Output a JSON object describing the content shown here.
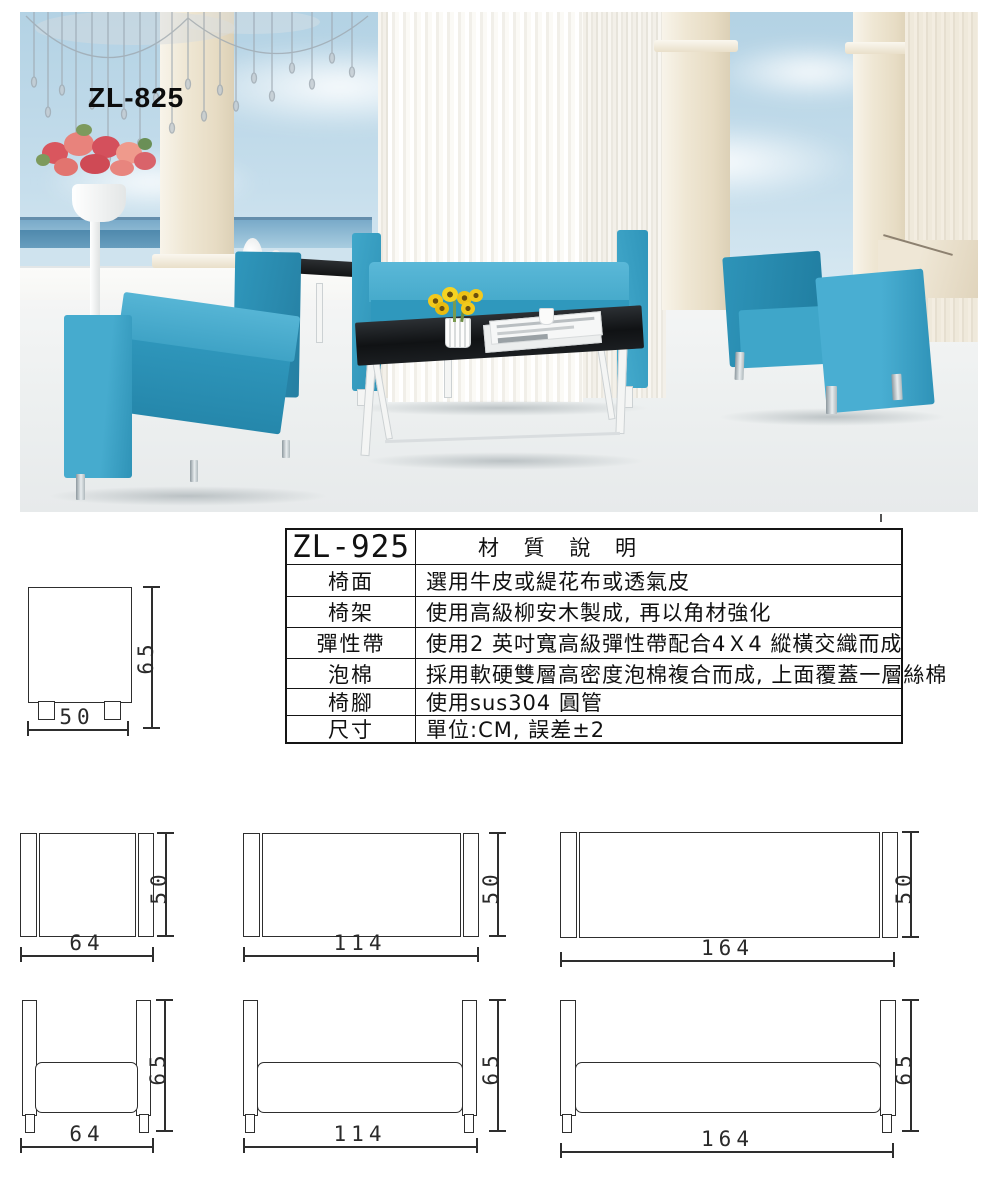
{
  "product": {
    "photo_label": "ZL-825"
  },
  "spec_table": {
    "model": "ZL-925",
    "title": "材 質 說 明",
    "rows": [
      {
        "label": "椅面",
        "value": "選用牛皮或緹花布或透氣皮"
      },
      {
        "label": "椅架",
        "value": "使用高級柳安木製成, 再以角材強化"
      },
      {
        "label": "彈性帶",
        "value": "使用2 英吋寬高級彈性帶配合4Ｘ4 縱橫交織而成"
      },
      {
        "label": "泡棉",
        "value": "採用軟硬雙層高密度泡棉複合而成, 上面覆蓋一層絲棉"
      },
      {
        "label": "椅腳",
        "value": "使用sus304 圓管"
      },
      {
        "label": "尺寸",
        "value": "單位:CM, 誤差±2"
      }
    ]
  },
  "drawings": {
    "side_view": {
      "width": "50",
      "height": "65"
    },
    "top_views": [
      {
        "width": "64",
        "depth": "50"
      },
      {
        "width": "114",
        "depth": "50"
      },
      {
        "width": "164",
        "depth": "50"
      }
    ],
    "front_views": [
      {
        "width": "64",
        "height": "65"
      },
      {
        "width": "114",
        "height": "65"
      },
      {
        "width": "164",
        "height": "65"
      }
    ]
  },
  "colors": {
    "sofa_blue": "#3aa3c8",
    "sofa_blue_dark": "#2a8db2",
    "glass_table_black": "#17191c",
    "sky_blue": "#bed9e8",
    "sea_blue": "#5e93b5",
    "column_cream": "#ece3d1",
    "floor_white": "#f0f2f2",
    "drawing_line": "#2e2e2e"
  }
}
